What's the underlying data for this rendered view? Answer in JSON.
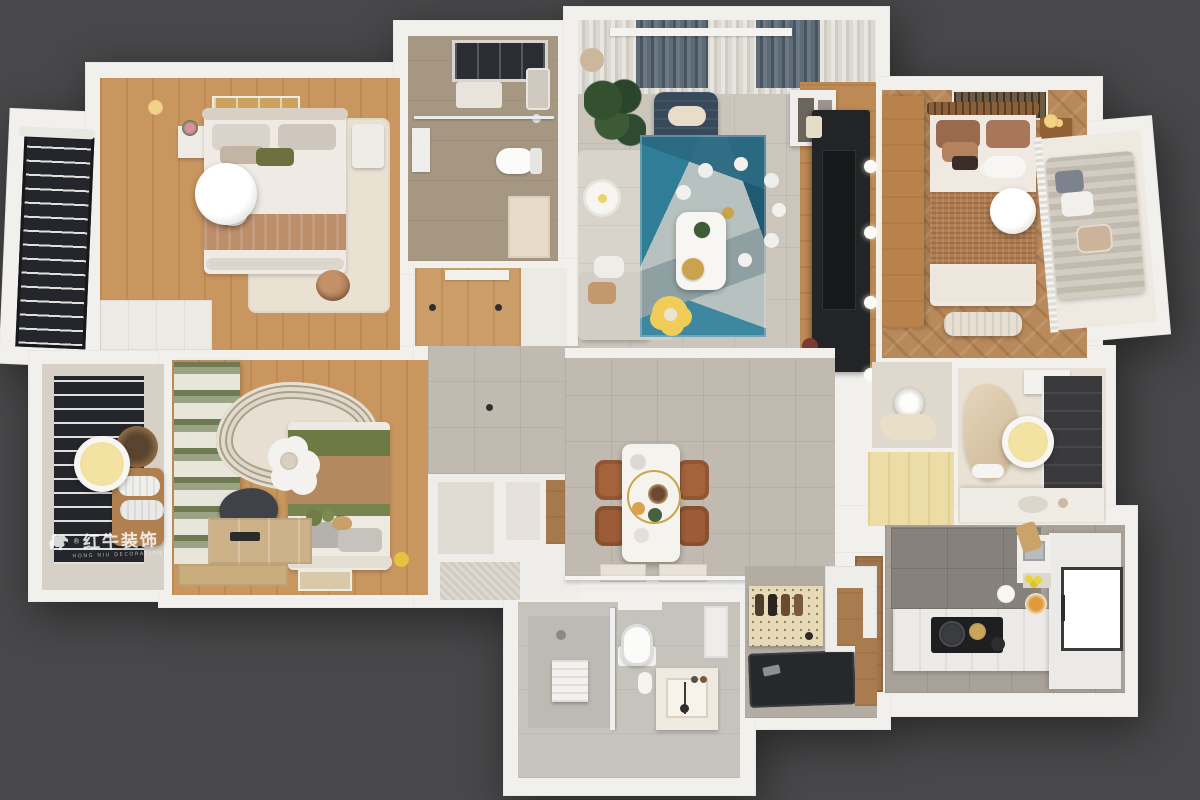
{
  "scene": {
    "description": "3D top-down dollhouse render of a three-bedroom apartment interior",
    "background_color": "#48484a",
    "wall_color": "#f1f0ed"
  },
  "watermark": {
    "icon": "bull-logo",
    "registered": "®",
    "brand_cn": "红牛装饰",
    "brand_en": "HONG NIU DECORATION",
    "color": "#ffffff"
  },
  "palette": {
    "wood_floor": "#c9965f",
    "chevron_wood": "#b8895a",
    "grey_tile": "#c1bab0",
    "taupe_bath_tile": "#a59781",
    "kitchen_tile": "#a8a199",
    "rug_cream": "#e9e1d2",
    "rug_teal": "#2d7b92",
    "rug_navy": "#235a74",
    "sofa_grey": "#d8d4cb",
    "armchair_navy": "#39495c",
    "blanket_tan": "#bd8e6a",
    "olive_green": "#6d7a44",
    "chair_brown": "#a5633c",
    "gold": "#c9a44c",
    "pouf_yellow": "#f0cd58",
    "black_console": "#232426",
    "pegboard": "#e7dab6",
    "door_wood": "#a0744c",
    "lamp_yellow": "#f3e3a2"
  },
  "rooms": [
    {
      "id": "bedroom-top-left",
      "label": "secondary bedroom",
      "furniture": [
        "double-bed",
        "tan-blanket",
        "olive-pillow",
        "nightstand-flowers",
        "dresser",
        "pendant-lamp",
        "floor-lamp",
        "knot-ball-pillow",
        "cream-rug",
        "wardrobe",
        "wall-art"
      ]
    },
    {
      "id": "balcony-top-left",
      "label": "balcony",
      "furniture": [
        "black-frame-window",
        "drying-rack",
        "curtains"
      ]
    },
    {
      "id": "bathroom-top",
      "label": "bathroom with skylight",
      "furniture": [
        "skylight",
        "shower-glass",
        "toilet",
        "vanity-mirror",
        "bath-mat",
        "door"
      ]
    },
    {
      "id": "living-room",
      "label": "living room",
      "furniture": [
        "curtains",
        "navy-lounge-chair",
        "monstera-plant",
        "l-shaped-sofa",
        "daisy-pillow",
        "geometric-blue-rug",
        "gold-chandelier",
        "white-coffee-table",
        "gold-tray",
        "yellow-flower-pouf",
        "tv-console-black",
        "tv-wood-wall",
        "wall-spotlights",
        "art-shelf"
      ]
    },
    {
      "id": "master-bedroom",
      "label": "master bedroom",
      "furniture": [
        "wood-wardrobe",
        "double-bed",
        "rattan-headboard",
        "jute-blanket",
        "cloud-pillow",
        "bed-bench",
        "nightstand-gold-lamp",
        "pendant-lamp",
        "ac-vent",
        "chevron-floor"
      ]
    },
    {
      "id": "balcony-right",
      "label": "balcony",
      "furniture": [
        "striped-daybed",
        "pillows",
        "sheer-curtains"
      ]
    },
    {
      "id": "reading-balcony-left",
      "label": "reading nook balcony",
      "furniture": [
        "venetian-blinds",
        "yellow-ceiling-lamp",
        "wood-lounge-chair",
        "cushion-rolls",
        "basket"
      ]
    },
    {
      "id": "bedroom-two",
      "label": "kids bedroom",
      "furniture": [
        "green-striped-curtains",
        "wavy-cream-rug",
        "bed-olive-tan",
        "pillow-set",
        "flower-lamp",
        "desk-chair",
        "desk-boxes",
        "floor-picture-frame",
        "toy-duck"
      ]
    },
    {
      "id": "hallway",
      "label": "hallway",
      "furniture": [
        "wood-floor-strip",
        "storage-closets",
        "wood-cabinet",
        "downlights"
      ]
    },
    {
      "id": "dining-area",
      "label": "dining area",
      "furniture": [
        "marble-dining-table",
        "gold-ring-chandelier",
        "leather-chairs-x4",
        "placemats",
        "half-wall"
      ]
    },
    {
      "id": "ensuite-bathroom",
      "label": "ensuite bathroom",
      "furniture": [
        "curved-lounger",
        "dark-shower-zone",
        "vanity-sink",
        "yellow-ceiling-lamp",
        "wall-cabinet",
        "towel"
      ]
    },
    {
      "id": "utility-room",
      "label": "utility room",
      "furniture": [
        "washer"
      ]
    },
    {
      "id": "cloakroom",
      "label": "cloakroom",
      "furniture": [
        "light-wood-floor"
      ]
    },
    {
      "id": "kitchen",
      "label": "kitchen",
      "furniture": [
        "l-counter",
        "black-cooktop",
        "pots",
        "fridge",
        "steel-sink",
        "lemons",
        "orange-plate",
        "cutting-board",
        "paper-towel",
        "wood-door"
      ]
    },
    {
      "id": "entryway",
      "label": "entryway",
      "furniture": [
        "shoe-pegboard",
        "hanging-shoes",
        "black-floor-mat",
        "shoe-cabinet",
        "wood-panels"
      ]
    },
    {
      "id": "bathroom-bottom",
      "label": "guest bathroom",
      "furniture": [
        "shower-zone",
        "bench",
        "glass-partition",
        "toilet",
        "vanity-basin",
        "niche-shelf"
      ]
    }
  ]
}
